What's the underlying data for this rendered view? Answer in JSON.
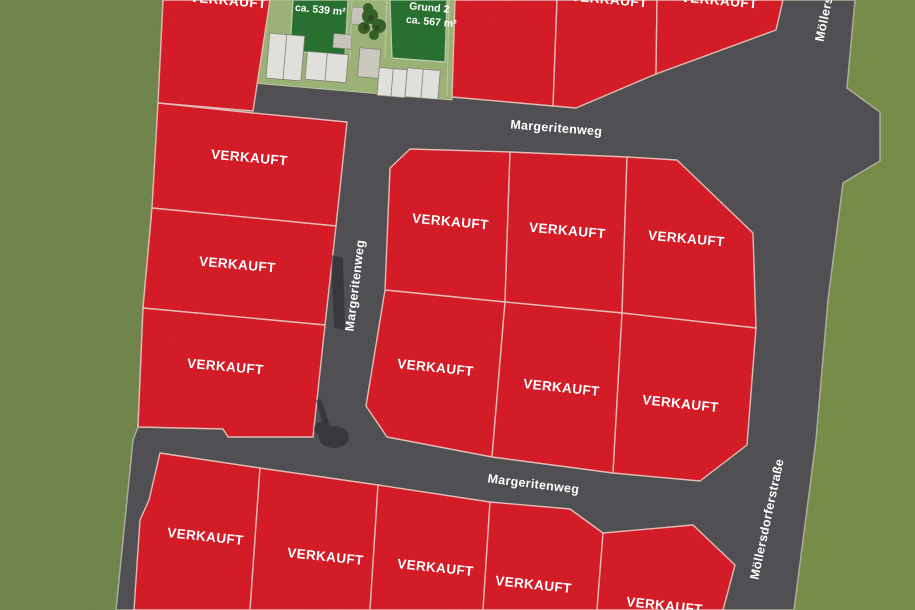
{
  "map": {
    "sold_label": "VERKAUFT",
    "streets": {
      "margeritenweg": "Margeritenweg",
      "moellersdorferstrasse": "Möllersdorferstraße"
    },
    "available_plots": [
      {
        "area": "ca. 539 m²"
      },
      {
        "name": "Grund 2",
        "area": "ca. 567 m²"
      }
    ],
    "colors": {
      "grass": "#7a9052",
      "grass_right": "#81984f",
      "street": "#57565a",
      "plot_sold": "#e51f2b",
      "plot_boundary_line": "#f6cbc5",
      "plot_available": "#2c7a34",
      "garden": "#a9c180",
      "label_text": "#ffffff"
    }
  }
}
